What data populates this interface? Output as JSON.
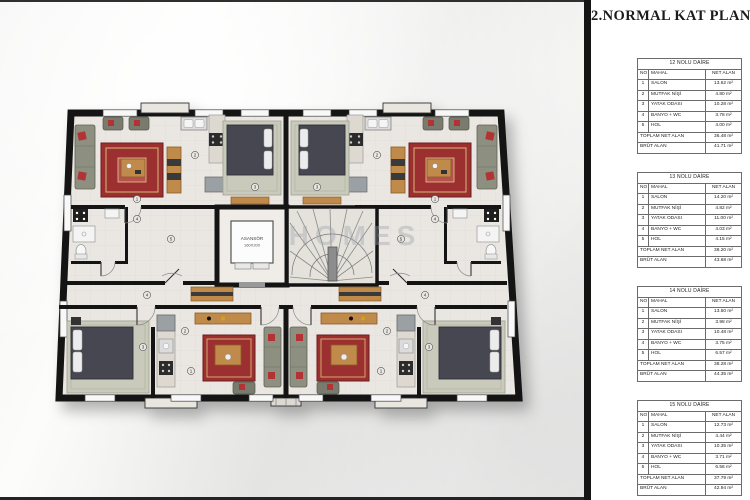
{
  "page": {
    "title": "2.NORMAL KAT PLANI"
  },
  "table_labels": {
    "no": "NO",
    "mahal": "MAHAL",
    "net_alan": "NET ALAN",
    "toplam_net_alan": "TOPLAM NET ALAN",
    "brut_alan": "BRÜT ALAN"
  },
  "apartments": [
    {
      "title": "12 NOLU DAİRE",
      "rooms": [
        [
          "1",
          "SALON",
          "13.62 m²"
        ],
        [
          "2",
          "MUTFAK NİŞİ",
          "4.80 m²"
        ],
        [
          "3",
          "YATAK ODASI",
          "10.28 m²"
        ],
        [
          "4",
          "BANYO + WC",
          "3.78 m²"
        ],
        [
          "5",
          "HOL",
          "4.00 m²"
        ]
      ],
      "toplam": "36.48 m²",
      "brut": "41.71 m²"
    },
    {
      "title": "13 NOLU DAİRE",
      "rooms": [
        [
          "1",
          "SALON",
          "14.20 m²"
        ],
        [
          "2",
          "MUTFAK NİŞİ",
          "4.82 m²"
        ],
        [
          "3",
          "YATAK ODASI",
          "11.00 m²"
        ],
        [
          "4",
          "BANYO + WC",
          "4.03 m²"
        ],
        [
          "5",
          "HOL",
          "4.15 m²"
        ]
      ],
      "toplam": "38.20 m²",
      "brut": "43.68 m²"
    },
    {
      "title": "14 NOLU DAİRE",
      "rooms": [
        [
          "1",
          "SALON",
          "13.50 m²"
        ],
        [
          "2",
          "MUTFAK NİŞİ",
          "3.98 m²"
        ],
        [
          "3",
          "YATAK ODASI",
          "10.48 m²"
        ],
        [
          "4",
          "BANYO + WC",
          "3.75 m²"
        ],
        [
          "5",
          "HOL",
          "6.57 m²"
        ]
      ],
      "toplam": "38.28 m²",
      "brut": "44.35 m²"
    },
    {
      "title": "15 NOLU DAİRE",
      "rooms": [
        [
          "1",
          "SALON",
          "12.73 m²"
        ],
        [
          "2",
          "MUTFAK NİŞİ",
          "4.44 m²"
        ],
        [
          "3",
          "YATAK ODASI",
          "10.35 m²"
        ],
        [
          "4",
          "BANYO + WC",
          "3.71 m²"
        ],
        [
          "5",
          "HOL",
          "6.56 m²"
        ]
      ],
      "toplam": "37.79 m²",
      "brut": "42.94 m²"
    }
  ],
  "plan": {
    "elevator_label": "ASANSÖR",
    "elevator_size": "160X200",
    "watermark": "HOMES",
    "room_numbers": [
      "1",
      "2",
      "3",
      "4",
      "5"
    ]
  }
}
